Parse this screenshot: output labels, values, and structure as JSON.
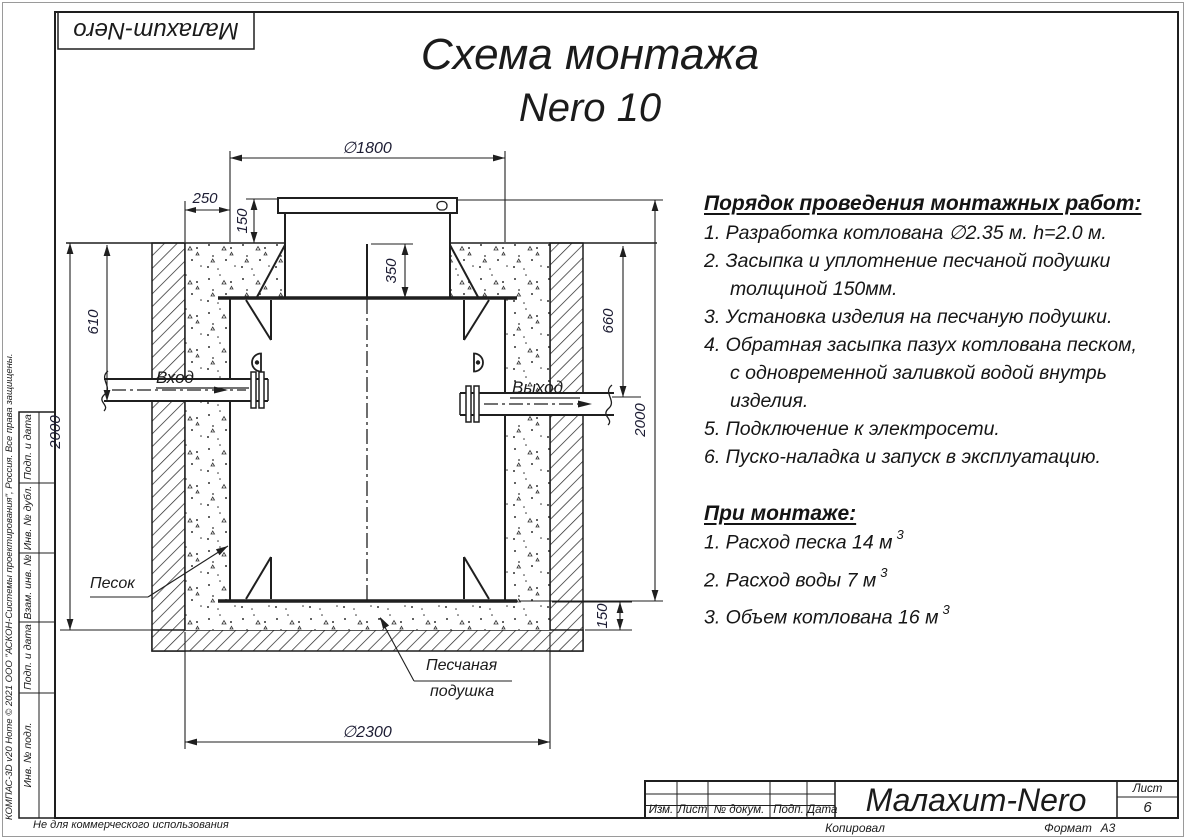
{
  "logo": {
    "text": "Малахит-Nero"
  },
  "title": {
    "line1": "Схема монтажа",
    "line2": "Nero 10"
  },
  "steps": {
    "heading": "Порядок проведения монтажных работ:",
    "items": [
      "1. Разработка котлована ∅2.35 м. h=2.0 м.",
      "2. Засыпка и уплотнение песчаной подушки толщиной 150мм.",
      "3. Установка изделия на песчаную подушки.",
      "4. Обратная засыпка пазух котлована песком, с одновременной заливкой водой внутрь изделия.",
      "5. Подключение к электросети.",
      "6. Пуско-наладка и запуск в эксплуатацию."
    ]
  },
  "mount": {
    "heading": "При монтаже:",
    "items": [
      {
        "text": "1. Расход песка 14 м",
        "sup": "3"
      },
      {
        "text": "2. Расход воды 7 м",
        "sup": "3"
      },
      {
        "text": "3. Объем котлована 16 м",
        "sup": "3"
      }
    ]
  },
  "drawing": {
    "dims": {
      "d1800": "∅1800",
      "gap250": "250",
      "lid150": "150",
      "neck350": "350",
      "inlet610": "610",
      "depth2000_left": "2000",
      "outlet660": "660",
      "height2000_right": "2000",
      "cushion150": "150",
      "d2300": "∅2300"
    },
    "labels": {
      "inlet": "Вход",
      "outlet": "Выход",
      "sand": "Песок",
      "cushion_line1": "Песчаная",
      "cushion_line2": "подушка"
    }
  },
  "title_block": {
    "columns": [
      "Изм.",
      "Лист",
      "№ докум.",
      "Подп.",
      "Дата"
    ],
    "company": "Малахит-Nero",
    "sheet_label": "Лист",
    "sheet_number": "6",
    "copied_by": "Копировал",
    "format_label": "Формат",
    "format_value": "А3"
  },
  "side_stamp": {
    "copyright": "КОМПАС-3D v20 Home © 2021 ООО \"АСКОН-Системы проектирования\", Россия. Все права защищены.",
    "cells": [
      "Подп. и дата",
      "Инв. № дубл.",
      "Взам. инв. №",
      "Подп. и дата",
      "Инв. № подл."
    ],
    "note": "Не для коммерческого использования"
  }
}
